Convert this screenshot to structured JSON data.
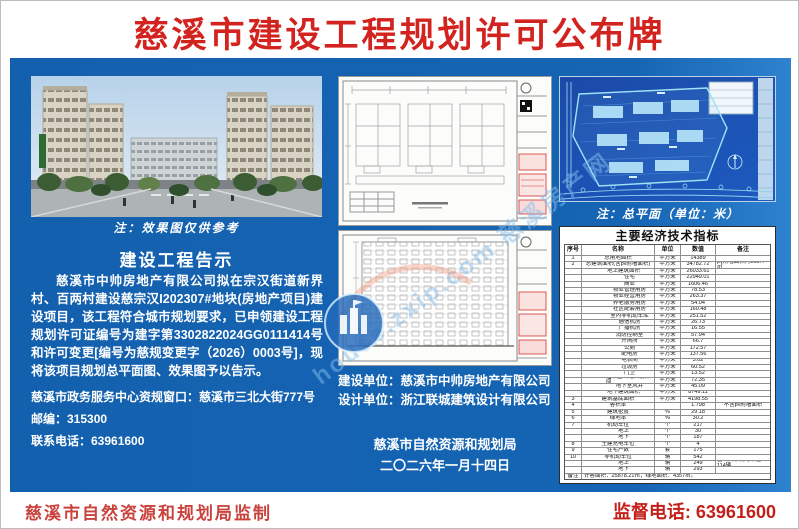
{
  "title": "慈溪市建设工程规划许可公布牌",
  "colors": {
    "panel_blue": "#1565b4",
    "title_red": "#d3231f",
    "footer_red": "#c4201a",
    "blueprint_blue": "#1c4fb0"
  },
  "left": {
    "image_caption": "注：效果图仅供参考",
    "notice_title": "建设工程告示",
    "notice_body": "慈溪市中帅房地产有限公司拟在宗汉街道新界村、百两村建设慈宗汉I202307#地块(房地产项目)建设项目，该工程符合城市规划要求，已申领建设工程规划许可证编号为建字第3302822024GG0111414号和许可变更[编号为慈规变更字（2026）0003号]，现将该项目规划总平面图、效果图予以告示。",
    "office_line": "慈溪市政务服务中心资规窗口：慈溪市三北大街777号",
    "postcode_line": "邮编：315300",
    "phone_line": "联系电话：63961600"
  },
  "middle": {
    "builder_line": "建设单位：慈溪市中帅房地产有限公司",
    "designer_line": "设计单位：浙江联城建筑设计有限公司",
    "issuer": "慈溪市自然资源和规划局",
    "date": "二〇二六年一月十四日"
  },
  "right": {
    "plan_caption": "注：总平面（单位：米）",
    "table": {
      "title": "主要经济技术指标",
      "headers": [
        "序号",
        "名称",
        "单位",
        "数值",
        "备注"
      ],
      "rows": [
        {
          "sn": "1",
          "indent": 0,
          "name": "总用地面积",
          "unit": "平方米",
          "value": "14389",
          "note": ""
        },
        {
          "sn": "2",
          "indent": 0,
          "name": "总建筑面积(含pv附墙面积)",
          "unit": "平方米",
          "value": "34782.72",
          "note": "pv附墙面积为155.4㎡"
        },
        {
          "sn": "",
          "indent": 1,
          "name": "地上建筑面积",
          "unit": "平方米",
          "value": "26033.61",
          "note": ""
        },
        {
          "sn": "",
          "indent": 2,
          "name": "住宅",
          "unit": "平方米",
          "value": "22949.01",
          "note": ""
        },
        {
          "sn": "",
          "indent": 2,
          "name": "商业",
          "unit": "平方米",
          "value": "1606.46",
          "note": ""
        },
        {
          "sn": "",
          "indent": 2,
          "name": "物业管理用房",
          "unit": "平方米",
          "value": "78.53",
          "note": ""
        },
        {
          "sn": "",
          "indent": 2,
          "name": "物业经营用房",
          "unit": "平方米",
          "value": "263.37",
          "note": ""
        },
        {
          "sn": "",
          "indent": 2,
          "name": "养老服务用房",
          "unit": "平方米",
          "value": "54.04",
          "note": ""
        },
        {
          "sn": "",
          "indent": 2,
          "name": "社区配套用房",
          "unit": "平方米",
          "value": "160.48",
          "note": ""
        },
        {
          "sn": "",
          "indent": 2,
          "name": "室内非机动车库",
          "unit": "平方米",
          "value": "251.52",
          "note": ""
        },
        {
          "sn": "",
          "indent": 2,
          "name": "通信机房",
          "unit": "平方米",
          "value": "26.73",
          "note": ""
        },
        {
          "sn": "",
          "indent": 2,
          "name": "广播机房",
          "unit": "平方米",
          "value": "16.55",
          "note": ""
        },
        {
          "sn": "",
          "indent": 2,
          "name": "消防控制室",
          "unit": "平方米",
          "value": "57.94",
          "note": ""
        },
        {
          "sn": "",
          "indent": 2,
          "name": "开闭所",
          "unit": "平方米",
          "value": "66.7",
          "note": ""
        },
        {
          "sn": "",
          "indent": 2,
          "name": "公厕",
          "unit": "平方米",
          "value": "172.57",
          "note": ""
        },
        {
          "sn": "",
          "indent": 2,
          "name": "配电房",
          "unit": "平方米",
          "value": "137.56",
          "note": ""
        },
        {
          "sn": "",
          "indent": 2,
          "name": "电表间",
          "unit": "平方米",
          "value": "3.02",
          "note": ""
        },
        {
          "sn": "",
          "indent": 2,
          "name": "垃圾房",
          "unit": "平方米",
          "value": "60.52",
          "note": ""
        },
        {
          "sn": "",
          "indent": 2,
          "name": "门卫",
          "unit": "平方米",
          "value": "13.52",
          "note": ""
        },
        {
          "sn": "",
          "indent": 2,
          "name": "地下室出地面楼梯间",
          "unit": "平方米",
          "value": "72.35",
          "note": ""
        },
        {
          "sn": "",
          "indent": 2,
          "name": "地下室风井",
          "unit": "平方米",
          "value": "45.09",
          "note": ""
        },
        {
          "sn": "",
          "indent": 1,
          "name": "地下建筑面积",
          "unit": "平方米",
          "value": "8749.11",
          "note": ""
        },
        {
          "sn": "3",
          "indent": 0,
          "name": "建筑基底面积",
          "unit": "平方米",
          "value": "4198.55",
          "note": ""
        },
        {
          "sn": "4",
          "indent": 0,
          "name": "容积率",
          "unit": "",
          "value": "1.798",
          "note": "不含pv附墙面积"
        },
        {
          "sn": "5",
          "indent": 0,
          "name": "建筑密度",
          "unit": "%",
          "value": "29.18",
          "note": ""
        },
        {
          "sn": "6",
          "indent": 0,
          "name": "绿地率",
          "unit": "%",
          "value": "30.2",
          "note": ""
        },
        {
          "sn": "7",
          "indent": 0,
          "name": "机动车位",
          "unit": "个",
          "value": "217",
          "note": ""
        },
        {
          "sn": "",
          "indent": 1,
          "name": "地上",
          "unit": "个",
          "value": "30",
          "note": ""
        },
        {
          "sn": "",
          "indent": 1,
          "name": "地下",
          "unit": "个",
          "value": "187",
          "note": ""
        },
        {
          "sn": "8",
          "indent": 0,
          "name": "土建充电车位",
          "unit": "个",
          "value": "4",
          "note": ""
        },
        {
          "sn": "9",
          "indent": 0,
          "name": "住宅户数",
          "unit": "套",
          "value": "175",
          "note": ""
        },
        {
          "sn": "10",
          "indent": 0,
          "name": "非机动车位",
          "unit": "辆",
          "value": "542",
          "note": ""
        },
        {
          "sn": "",
          "indent": 1,
          "name": "地上",
          "unit": "辆",
          "value": "249",
          "note": "含公共非机动车位114辆"
        },
        {
          "sn": "",
          "indent": 1,
          "name": "地下",
          "unit": "辆",
          "value": "293",
          "note": ""
        },
        {
          "sn": "备注",
          "indent": 0,
          "name": "计容面积：25878.21㎡，绿地面积：4357㎡。",
          "unit": "",
          "value": "",
          "note": "",
          "remark": true
        }
      ]
    }
  },
  "footer": {
    "left": "慈溪市自然资源和规划局监制",
    "right": "监督电话: 63961600"
  },
  "watermark": {
    "text": "house.zxip.com 慈溪房产网"
  }
}
